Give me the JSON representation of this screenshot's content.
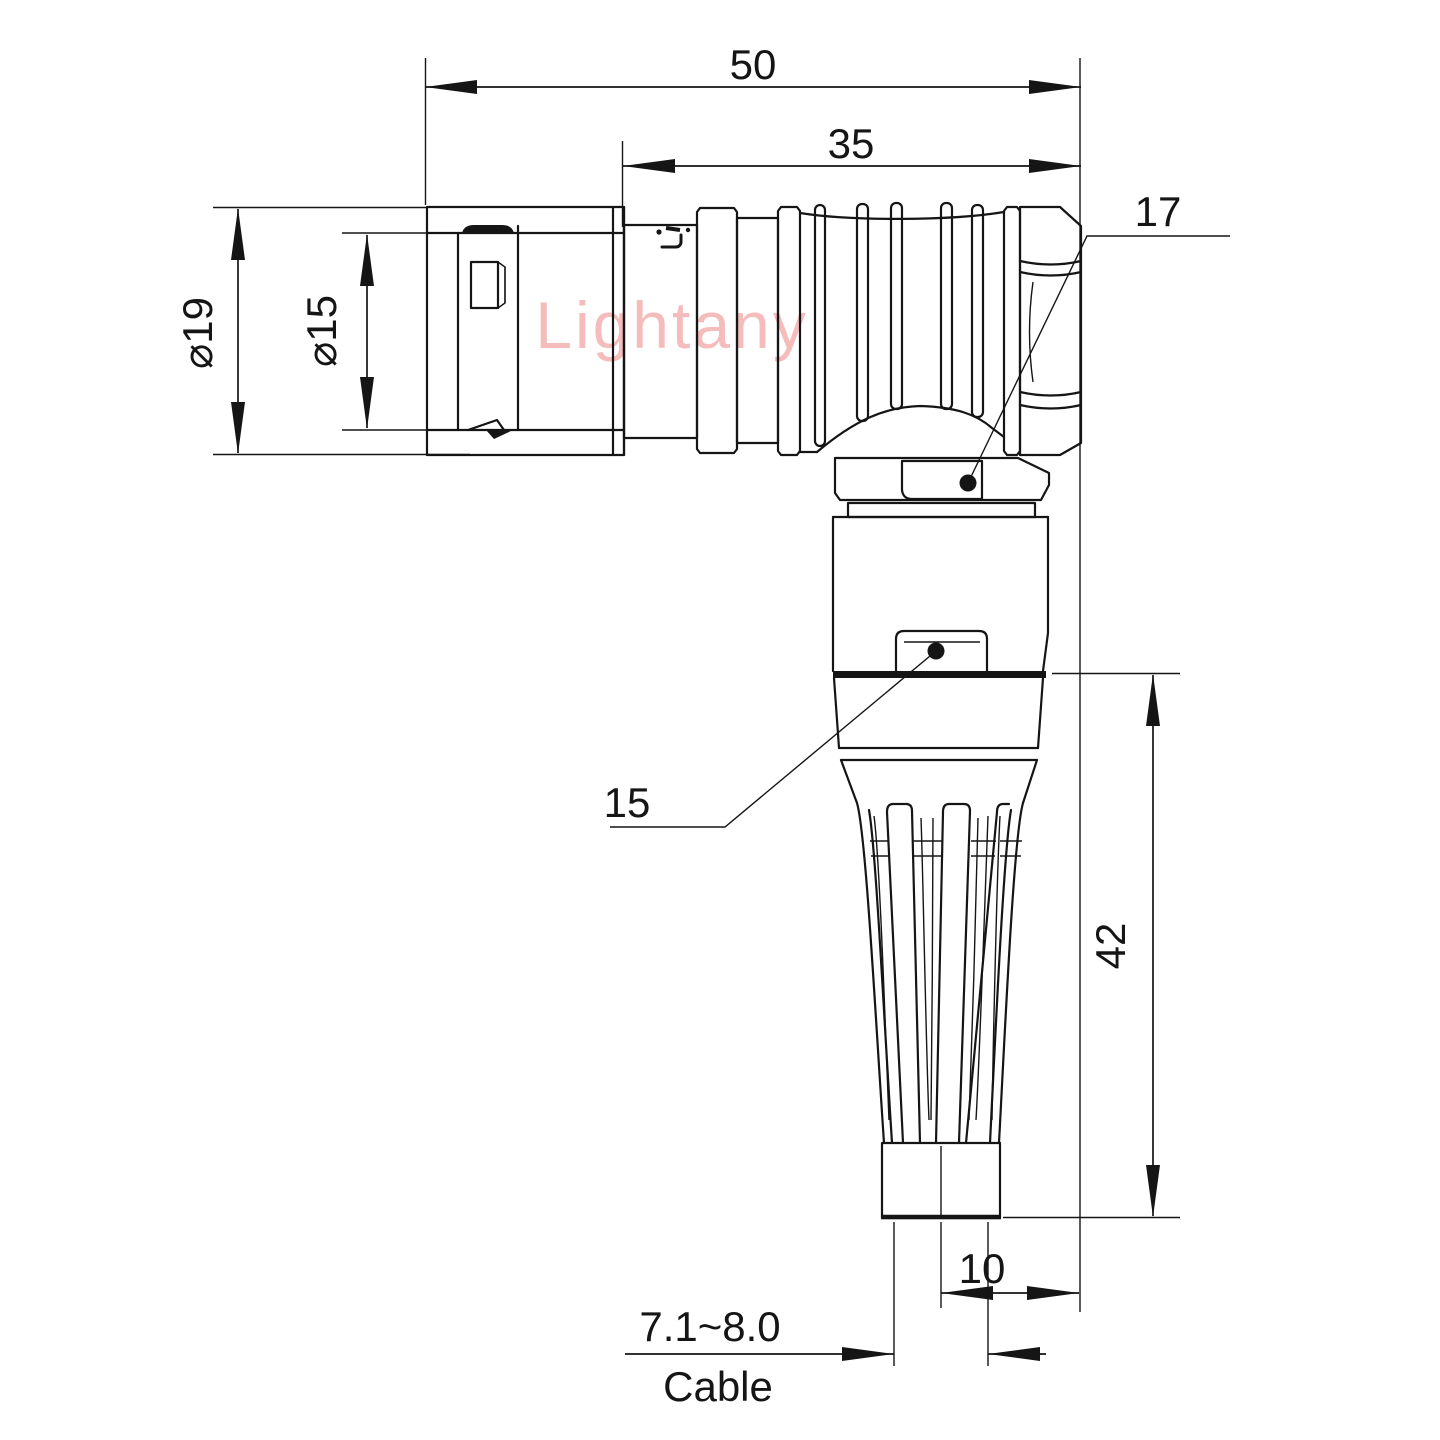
{
  "drawing": {
    "title": "right-angle circular connector with bend relief - dimensioned side view",
    "watermark": "Lightany",
    "colors": {
      "line": "#151515",
      "watermark": "#f5bcbc",
      "background": "#ffffff"
    },
    "dimensions": {
      "overall_length": "50",
      "body_length": "35",
      "outer_diameter": "⌀19",
      "coupling_diameter": "⌀15",
      "vertical_height": "42",
      "cable_axis_offset": "10",
      "cable_range": "7.1~8.0",
      "cable_word": "Cable"
    },
    "callouts": {
      "elbow_nut_size": "17",
      "body_size": "15"
    }
  }
}
